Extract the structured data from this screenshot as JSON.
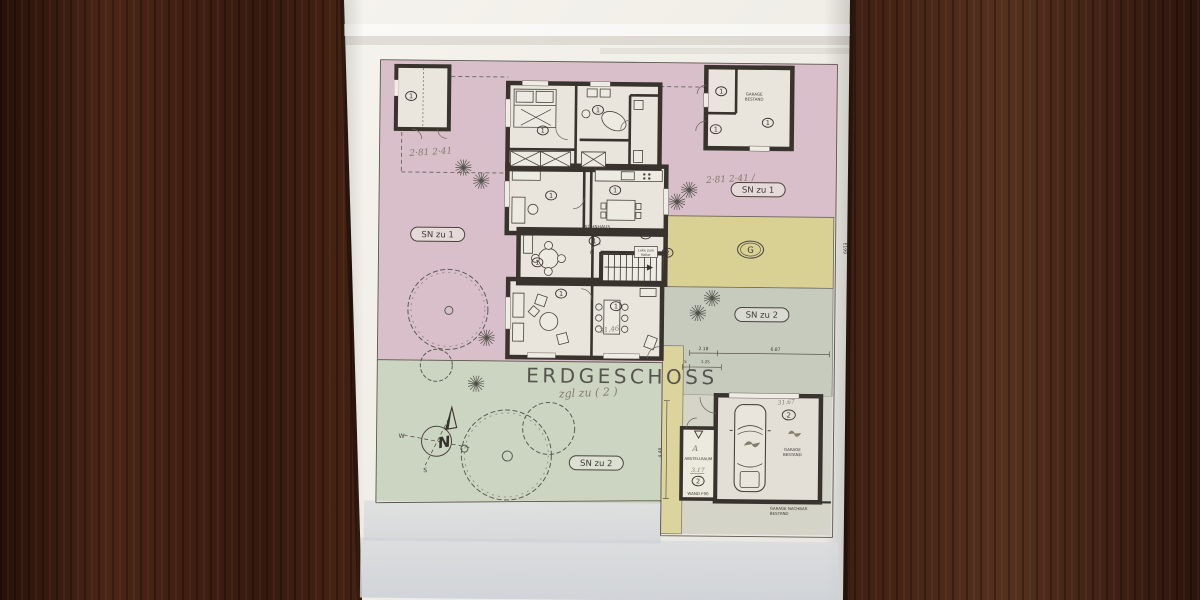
{
  "title": {
    "text": "ERDGESCHOSS"
  },
  "zone_labels": {
    "sn_zu_1_left": "SN zu 1",
    "sn_zu_1_right": "SN zu 1",
    "sn_zu_2_right": "SN zu 2",
    "sn_zu_2_bottom": "SN zu 2",
    "garage_g": "G"
  },
  "unit_marks": {
    "one": "1",
    "two": "2"
  },
  "room_labels": {
    "wohnhaus_line1": "WOHNHAUS",
    "wohnhaus_line2": "BESTAND",
    "luke_line1": "Luke zum",
    "luke_line2": "Keller",
    "abstellraum": "ABSTELLRAUM",
    "wand_f90": "WAND F90",
    "garage_right_line1": "GARAGE",
    "garage_right_line2": "BESTAND",
    "garage_top_line1": "GARAGE",
    "garage_top_line2": "BESTAND",
    "nachbar_line1": "GARAGE NACHBAR",
    "nachbar_line2": "BESTAND"
  },
  "handwritten_notes": {
    "title_note": "zgl zu ( 2 )",
    "dining_area": "31.46",
    "garage_area": "31.67",
    "abstell_area": "3.17",
    "abstell_letter": "A",
    "scribble_top_left": "2·81  2·41",
    "scribble_top_right": "2·81  2·41  /"
  },
  "dimensions": {
    "garage_width": "2.18",
    "garage_length": "6.87",
    "abstell_width": "1.25",
    "wall_tick": "5",
    "garage_depth": "4.46",
    "parcel_note": "E199"
  },
  "compass": {
    "north": "N",
    "west": "W",
    "south": "S"
  },
  "colors": {
    "wood": "#46251a",
    "paper": "#f1efe8",
    "zone_pink": "#d9bfca",
    "zone_yellow": "#d9d093",
    "zone_gray_green": "#c7cbbd",
    "zone_green": "#ccd5c1",
    "zone_yellow_strip": "#dbd49c",
    "floor": "#e9e5dd",
    "wall_ink": "#39332d"
  }
}
